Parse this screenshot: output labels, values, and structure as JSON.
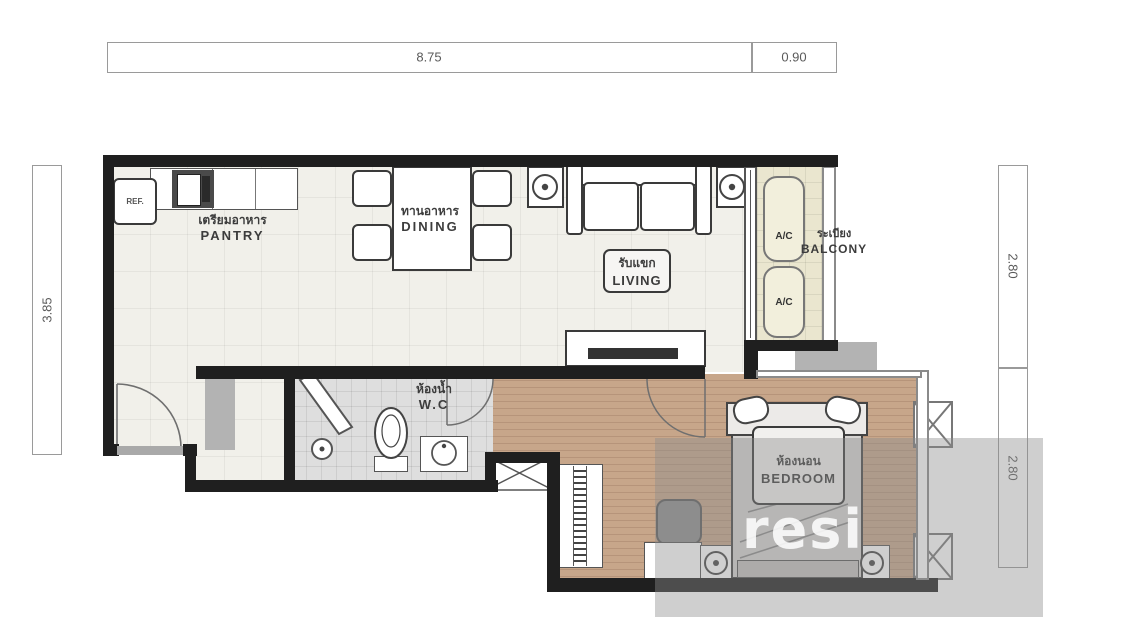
{
  "dimensions": {
    "top_main": "8.75",
    "top_right": "0.90",
    "left": "3.85",
    "right_upper": "2.80",
    "right_lower": "2.80"
  },
  "rooms": {
    "pantry": {
      "thai": "เตรียมอาหาร",
      "en": "PANTRY"
    },
    "dining": {
      "thai": "ทานอาหาร",
      "en": "DINING"
    },
    "living": {
      "thai": "รับแขก",
      "en": "LIVING"
    },
    "balcony": {
      "thai": "ระเบียง",
      "en": "BALCONY"
    },
    "wc": {
      "thai": "ห้องน้ำ",
      "en": "W.C"
    },
    "bedroom": {
      "thai": "ห้องนอน",
      "en": "BEDROOM"
    }
  },
  "appliances": {
    "fridge": "REF.",
    "ac": "A/C"
  },
  "watermark": {
    "text": "resi"
  },
  "colors": {
    "wall": "#1f1f1f",
    "cream_floor": "#f1f0ea",
    "balcony_floor": "#eae6cf",
    "wc_floor": "#dedede",
    "wood_floor": "#c7a68a",
    "watermark_gray": "#9a9a9a"
  }
}
